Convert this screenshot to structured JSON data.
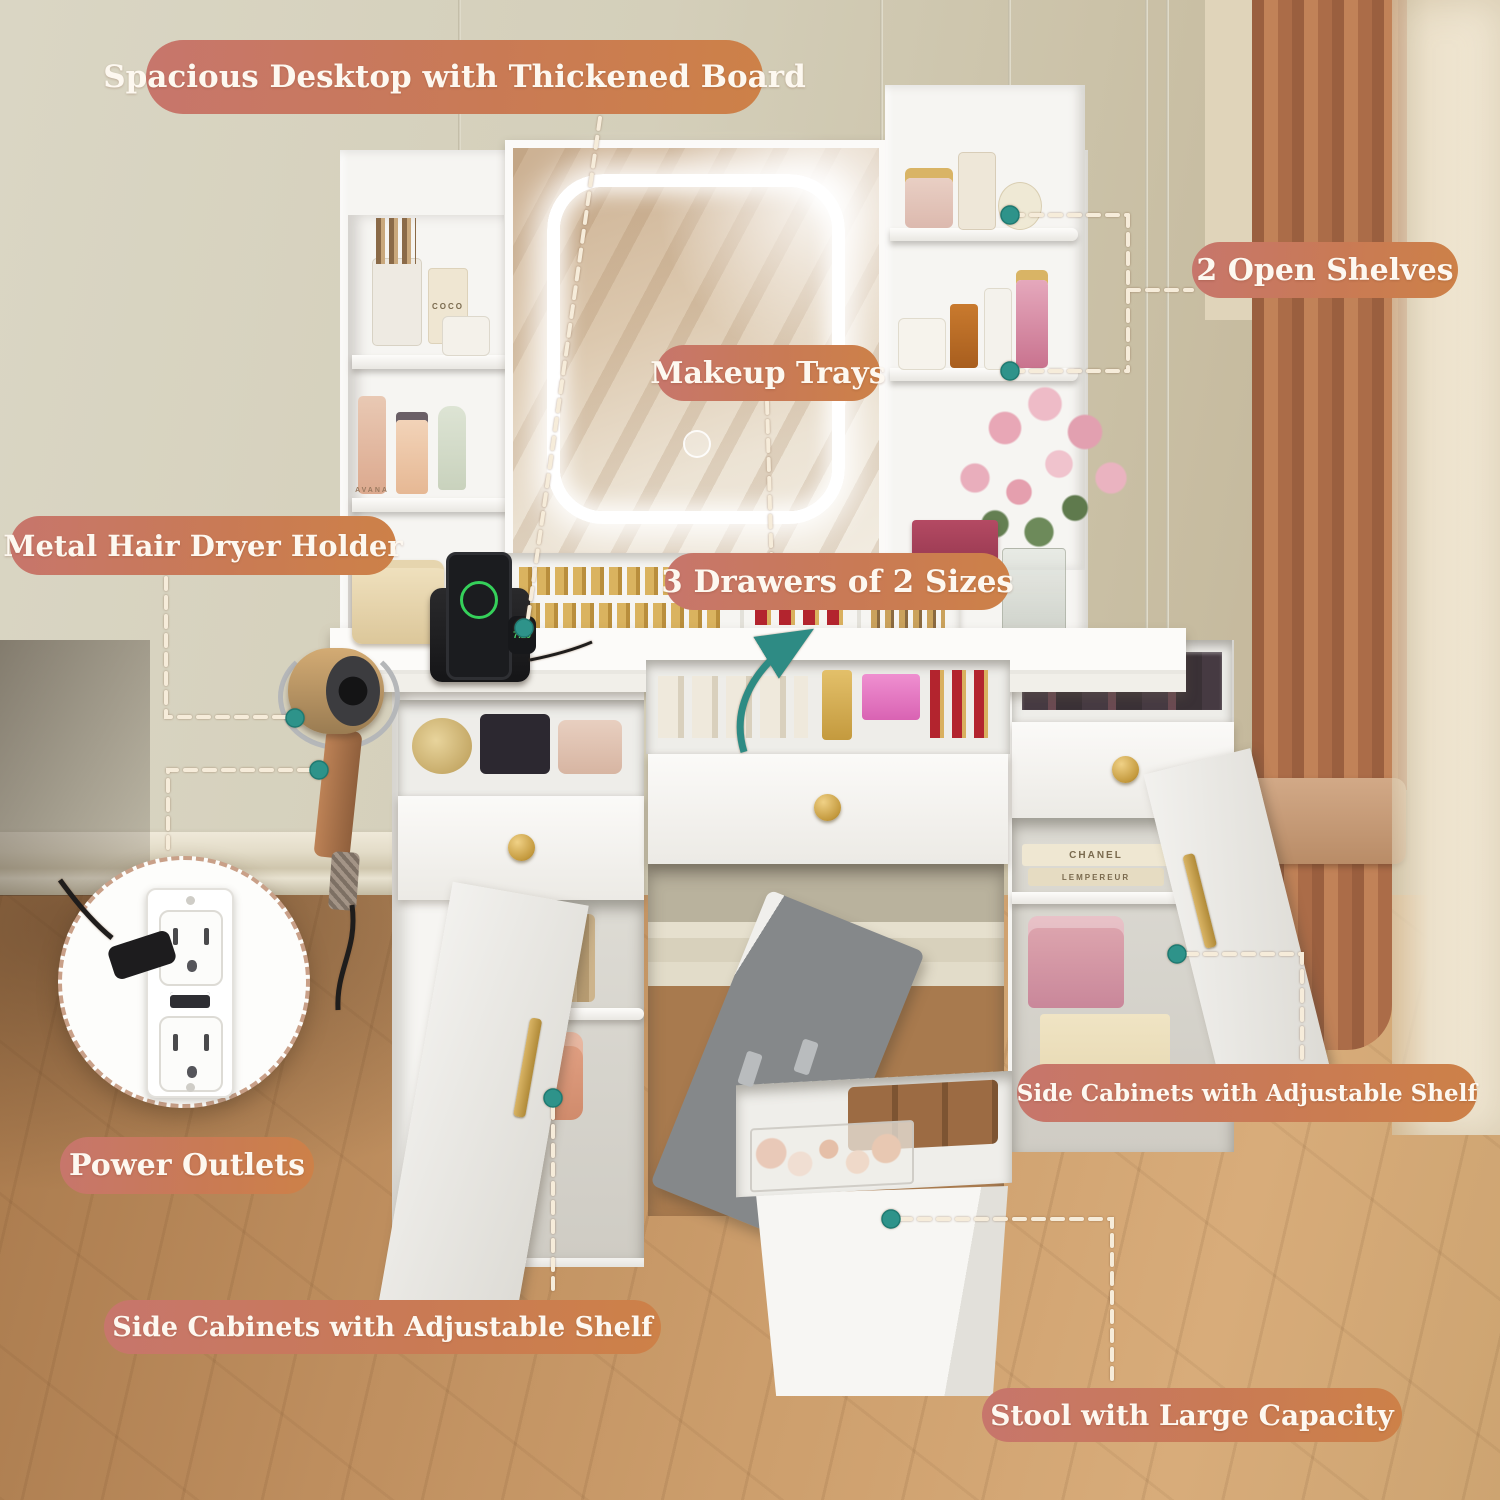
{
  "callouts": {
    "spacious_desktop": {
      "label": "Spacious Desktop with Thickened Board"
    },
    "open_shelves": {
      "label": "2 Open Shelves"
    },
    "makeup_trays": {
      "label": "Makeup Trays"
    },
    "three_drawers": {
      "label": "3 Drawers of 2 Sizes"
    },
    "hair_dryer": {
      "label": "Metal Hair Dryer Holder"
    },
    "power_outlets": {
      "label": "Power Outlets"
    },
    "side_cabinets_left": {
      "label": "Side Cabinets with Adjustable Shelf"
    },
    "side_cabinets_right": {
      "label": "Side Cabinets with Adjustable Shelf"
    },
    "stool": {
      "label": "Stool with Large Capacity"
    }
  },
  "scene_text": {
    "book_spine_top": "CHANEL",
    "book_spine_bottom": "LEMPEREUR",
    "watch_time": "7:29",
    "perfume_label": "COCO",
    "spray_label": "AVANA"
  },
  "colors": {
    "pill_gradient_start": "#c7766c",
    "pill_gradient_end": "#cd8148",
    "pill_text": "#fdf8f0",
    "leader_dash": "#f6ecda",
    "teal_accent": "#2e8b84",
    "wall": "#d6d2bf",
    "floor_wood": "#c9996a",
    "furniture_white": "#f6f5f2",
    "curtain_drape": "#ab6c48",
    "curtain_sheer": "#ece1cb",
    "gold_hardware": "#c49a3e"
  }
}
